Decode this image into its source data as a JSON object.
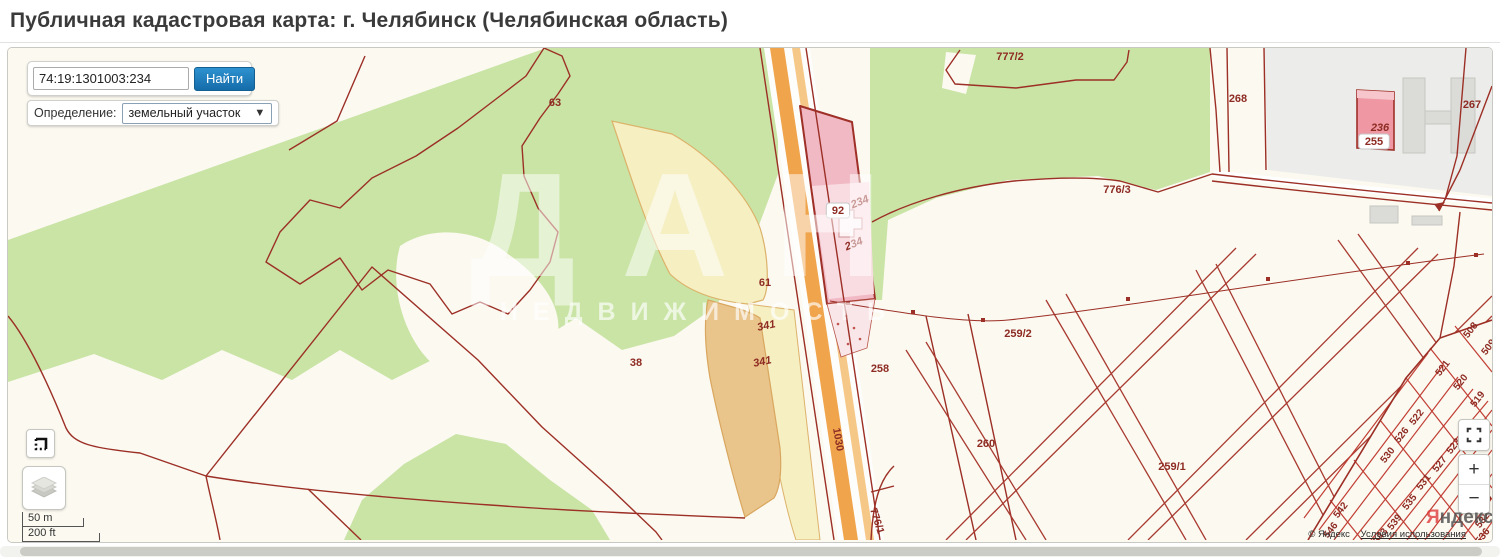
{
  "page": {
    "title": "Публичная кадастровая карта: г. Челябинск (Челябинская область)"
  },
  "search": {
    "value": "74:19:1301003:234",
    "button": "Найти"
  },
  "filter": {
    "label": "Определение:",
    "selected": "земельный участок"
  },
  "watermark": {
    "line1": "ДАН",
    "line2": "НЕДВИЖИМОСТЬ"
  },
  "scale": {
    "metric": "50 m",
    "imperial": "200 ft"
  },
  "controls": {
    "zoom_in": "+",
    "zoom_out": "−"
  },
  "attribution": {
    "logo_first": "Я",
    "logo_rest": "ндекс",
    "copyright": "© Яндекс",
    "terms": "Условия использования"
  },
  "colors": {
    "accent_blue": "#1878B8",
    "parcel_line": "#9C2F26",
    "selected_pink": "#F1B9C4",
    "road_orange": "#F0A44C",
    "forest_green": "#C9E4A5",
    "background_cream": "#FBF9F0"
  },
  "map": {
    "parcels": [
      {
        "label": "63",
        "x": 547,
        "y": 58
      },
      {
        "label": "38",
        "x": 628,
        "y": 318
      },
      {
        "label": "61",
        "x": 757,
        "y": 238
      },
      {
        "label": "341",
        "x": 759,
        "y": 281,
        "rot": -12,
        "italic": true
      },
      {
        "label": "341",
        "x": 755,
        "y": 317,
        "rot": -12,
        "italic": true
      },
      {
        "label": "92",
        "x": 830,
        "y": 166,
        "boxed": true
      },
      {
        "label": "234",
        "x": 853,
        "y": 157,
        "rot": -22,
        "italic": true
      },
      {
        "label": "234",
        "x": 847,
        "y": 199,
        "rot": -22,
        "italic": true
      },
      {
        "label": "258",
        "x": 872,
        "y": 324
      },
      {
        "label": "259/2",
        "x": 1010,
        "y": 289
      },
      {
        "label": "260",
        "x": 978,
        "y": 399
      },
      {
        "label": "259/1",
        "x": 1164,
        "y": 422
      },
      {
        "label": "776/3",
        "x": 1109,
        "y": 145
      },
      {
        "label": "777/2",
        "x": 1002,
        "y": 12
      },
      {
        "label": "268",
        "x": 1230,
        "y": 54
      },
      {
        "label": "267",
        "x": 1464,
        "y": 60
      },
      {
        "label": "236",
        "x": 1372,
        "y": 83,
        "italic": true
      },
      {
        "label": "255",
        "x": 1366,
        "y": 97,
        "boxed": true
      },
      {
        "label": "1030",
        "x": 827,
        "y": 392,
        "rot": 80,
        "s": 10.5
      },
      {
        "label": "776/1",
        "x": 866,
        "y": 474,
        "rot": 72,
        "s": 10.5
      },
      {
        "label": "508",
        "x": 1465,
        "y": 284,
        "rot": -52,
        "s": 10
      },
      {
        "label": "509",
        "x": 1483,
        "y": 301,
        "rot": -52,
        "s": 10
      },
      {
        "label": "521",
        "x": 1437,
        "y": 322,
        "rot": -52,
        "s": 10
      },
      {
        "label": "520",
        "x": 1455,
        "y": 336,
        "rot": -52,
        "s": 10
      },
      {
        "label": "519",
        "x": 1472,
        "y": 353,
        "rot": -52,
        "s": 10
      },
      {
        "label": "522",
        "x": 1411,
        "y": 371,
        "rot": -52,
        "s": 10
      },
      {
        "label": "526",
        "x": 1396,
        "y": 389,
        "rot": -52,
        "s": 10
      },
      {
        "label": "523",
        "x": 1448,
        "y": 400,
        "rot": -52,
        "s": 10
      },
      {
        "label": "530",
        "x": 1382,
        "y": 409,
        "rot": -52,
        "s": 10
      },
      {
        "label": "527",
        "x": 1434,
        "y": 418,
        "rot": -52,
        "s": 10
      },
      {
        "label": "531",
        "x": 1418,
        "y": 436,
        "rot": -52,
        "s": 10
      },
      {
        "label": "535",
        "x": 1404,
        "y": 456,
        "rot": -52,
        "s": 10
      },
      {
        "label": "539",
        "x": 1389,
        "y": 476,
        "rot": -52,
        "s": 10
      },
      {
        "label": "542",
        "x": 1335,
        "y": 464,
        "rot": -52,
        "s": 10
      },
      {
        "label": "546",
        "x": 1325,
        "y": 484,
        "rot": -52,
        "s": 10
      },
      {
        "label": "543",
        "x": 1375,
        "y": 490,
        "rot": -52,
        "s": 10
      },
      {
        "label": "528",
        "x": 1479,
        "y": 456,
        "rot": -52,
        "s": 10
      },
      {
        "label": "532",
        "x": 1477,
        "y": 474,
        "rot": -52,
        "s": 10
      },
      {
        "label": "536",
        "x": 1477,
        "y": 490,
        "rot": -52,
        "s": 10
      }
    ]
  }
}
